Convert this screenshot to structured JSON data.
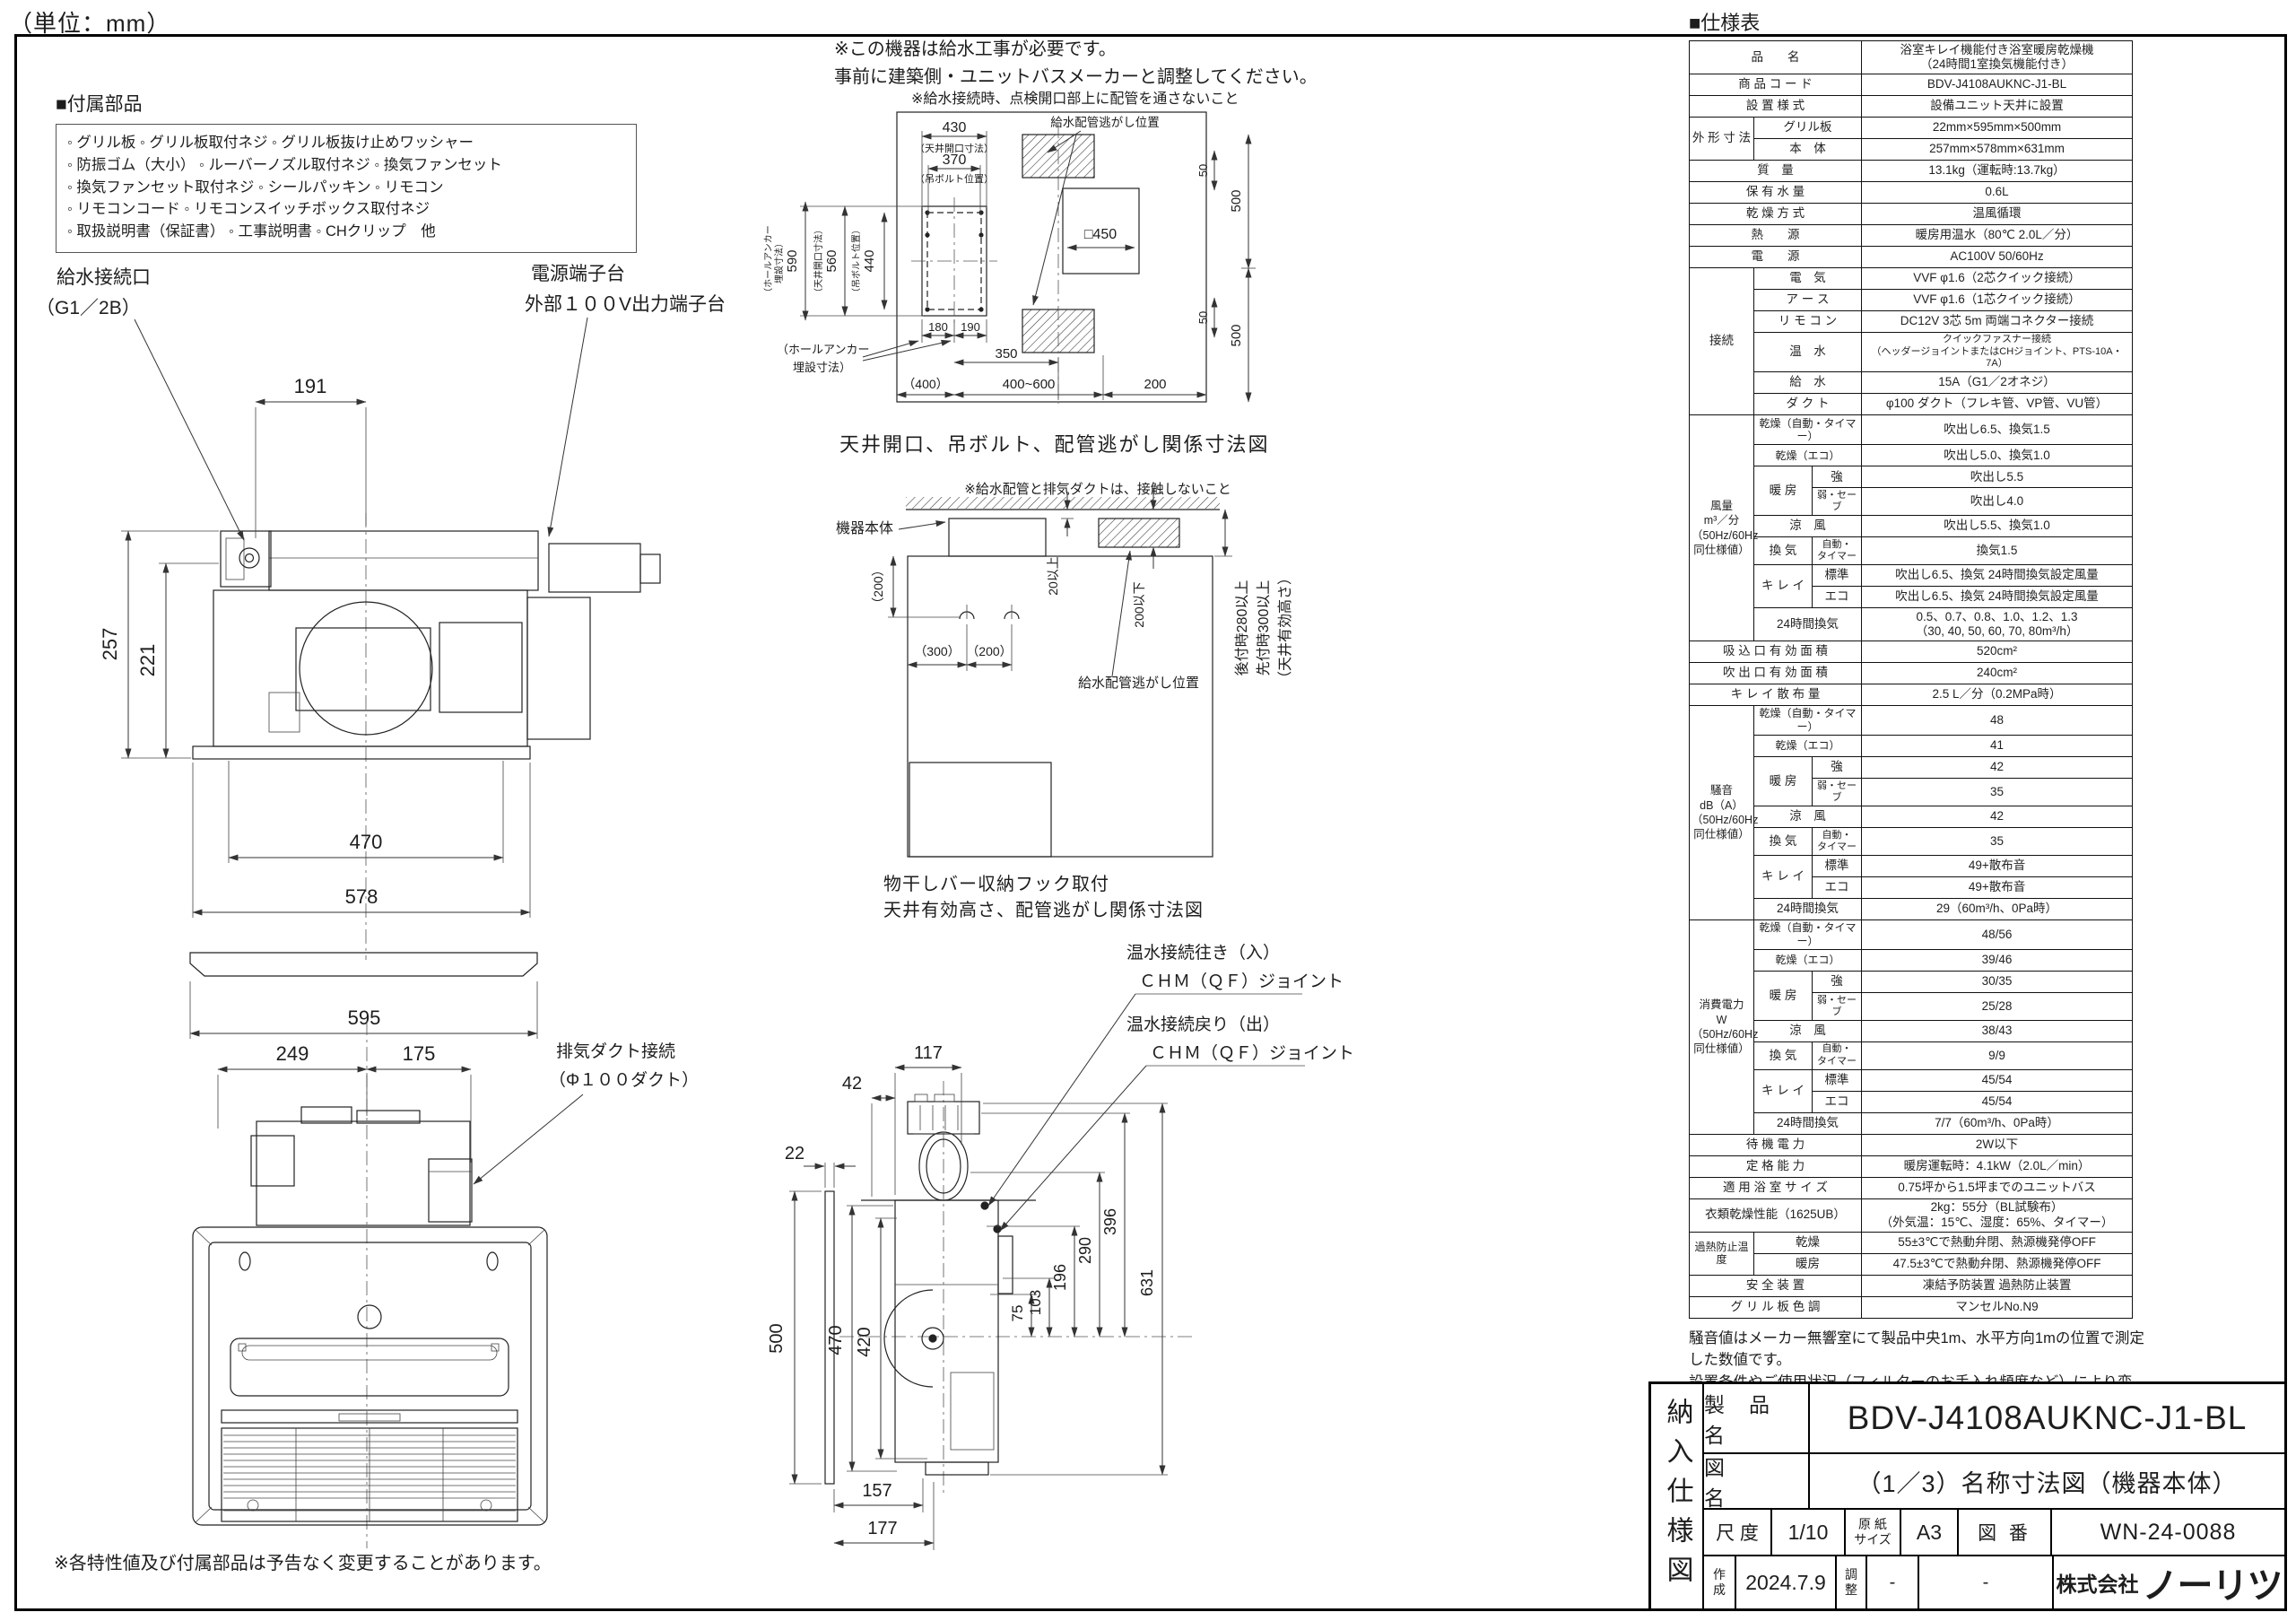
{
  "page": {
    "unit_note": "（単位：mm）",
    "footer_note": "※各特性値及び付属部品は予告なく変更することがあります。"
  },
  "accessories": {
    "heading": "■付属部品",
    "lines": [
      "◦ グリル板 ◦ グリル板取付ネジ ◦ グリル板抜け止めワッシャー",
      "◦ 防振ゴム（大小） ◦ ルーバーノズル取付ネジ ◦ 換気ファンセット",
      "◦ 換気ファンセット取付ネジ ◦ シールパッキン ◦ リモコン",
      "◦ リモコンコード ◦ リモコンスイッチボックス取付ネジ",
      "◦ 取扱説明書（保証書） ◦ 工事説明書 ◦ CHクリップ　他"
    ]
  },
  "top_notes": {
    "line1": "※この機器は給水工事が必要です。",
    "line2": "事前に建築側・ユニットバスメーカーと調整してください。",
    "pipe_note": "※給水接続時、点検開口部上に配管を通さないこと"
  },
  "ceiling_diagram": {
    "caption": "天井開口、吊ボルト、配管逃がし関係寸法図",
    "d430": "430",
    "cap430": "（天井開口寸法）",
    "d370": "370",
    "cap370": "（吊ボルト位置）",
    "d590": "590",
    "cap590a": "（ホールアンカー",
    "cap590b": "埋設寸法）",
    "d560": "560",
    "cap560": "（天井開口寸法）",
    "d440": "440",
    "cap440": "（吊ボルト位置）",
    "anchor_note1": "（ホールアンカー",
    "anchor_note2": "埋設寸法）",
    "d180": "180",
    "d190": "190",
    "d350": "350",
    "d400": "（400）",
    "d400_600": "400~600",
    "d200": "200",
    "pipe_label": "給水配管逃がし位置",
    "d50a": "50",
    "d500a": "500",
    "d450": "□450",
    "d500b": "500",
    "d50b": "50"
  },
  "top_view": {
    "label_water1": "給水接続口",
    "label_water2": "（G1／2B）",
    "label_power1": "電源端子台",
    "label_power2": "外部１００V出力端子台",
    "d191": "191",
    "d257": "257",
    "d221": "221",
    "d470": "470",
    "d578": "578",
    "d595": "595"
  },
  "install_diagram": {
    "note": "※給水配管と排気ダクトは、接触しないこと",
    "body_label": "機器本体",
    "d200p": "（200）",
    "d300p": "（300）",
    "d200p2": "（200）",
    "d20": "20以上",
    "d200max": "200以下",
    "pipe_label": "給水配管逃がし位置",
    "v1": "後付時280以上",
    "v2": "先付時300以上",
    "v3": "（天井有効高さ）",
    "caption1": "物干しバー収納フック取付",
    "caption2": "天井有効高さ、配管逃がし関係寸法図"
  },
  "front_view": {
    "d249": "249",
    "d175": "175",
    "duct_label1": "排気ダクト接続",
    "duct_label2": "（Φ１００ダクト）"
  },
  "side_view": {
    "d117": "117",
    "d42": "42",
    "d22": "22",
    "d500": "500",
    "d470": "470",
    "d420": "420",
    "d75": "75",
    "d103": "103",
    "d196": "196",
    "d290": "290",
    "d396": "396",
    "d631": "631",
    "d157": "157",
    "d177": "177",
    "hot_in1": "温水接続往き（入）",
    "hot_in2": "ＣＨＭ（ＱＦ）ジョイント",
    "hot_out1": "温水接続戻り（出）",
    "hot_out2": "ＣＨＭ（ＱＦ）ジョイント"
  },
  "spec": {
    "heading": "■仕様表",
    "note1": "騒音値はメーカー無響室にて製品中央1m、水平方向1mの位置で測定した数値です。",
    "note2": "設置条件やご使用状況（フィルターのお手入れ頻度など）により変わります。",
    "rows": [
      [
        "品　　名",
        "浴室キレイ機能付き浴室暖房乾燥機\n（24時間1室換気機能付き）"
      ],
      [
        "商 品 コ ー ド",
        "BDV-J4108AUKNC-J1-BL"
      ],
      [
        "設 置 様 式",
        "設備ユニット天井に設置"
      ],
      [
        "外 形 寸 法",
        "グリル板",
        "22mm×595mm×500mm"
      ],
      [
        "本　体",
        "257mm×578mm×631mm"
      ],
      [
        "質　量",
        "13.1kg（運転時:13.7kg）"
      ],
      [
        "保 有 水 量",
        "0.6L"
      ],
      [
        "乾 燥 方 式",
        "温風循環"
      ],
      [
        "熱　　源",
        "暖房用温水（80℃ 2.0L／分）"
      ],
      [
        "電　　源",
        "AC100V 50/60Hz"
      ],
      [
        "接続",
        "電　気",
        "VVF φ1.6（2芯クイック接続）"
      ],
      [
        "ア ー ス",
        "VVF φ1.6（1芯クイック接続）"
      ],
      [
        "リ モ コ ン",
        "DC12V 3芯 5m 両端コネクター接続"
      ],
      [
        "温　水",
        "クイックファスナー接続\n（ヘッダージョイントまたはCHジョイント、PTS-10A・7A）"
      ],
      [
        "給　水",
        "15A（G1／2オネジ）"
      ],
      [
        "ダ ク ト",
        "φ100 ダクト（フレキ管、VP管、VU管）"
      ],
      [
        "風量\nm³／分\n（50Hz/60Hz\n同仕様値）",
        "乾燥（自動・タイマー）",
        "吹出し6.5、換気1.5"
      ],
      [
        "乾燥（エコ）",
        "吹出し5.0、換気1.0"
      ],
      [
        "暖 房",
        "強",
        "吹出し5.5"
      ],
      [
        "弱・セーブ",
        "吹出し4.0"
      ],
      [
        "涼　風",
        "吹出し5.5、換気1.0"
      ],
      [
        "換 気",
        "自動・\nタイマー",
        "換気1.5"
      ],
      [
        "キ レ イ",
        "標準",
        "吹出し6.5、換気 24時間換気設定風量"
      ],
      [
        "エコ",
        "吹出し6.5、換気 24時間換気設定風量"
      ],
      [
        "24時間換気",
        "0.5、0.7、0.8、1.0、1.2、1.3\n（30, 40, 50, 60, 70, 80m³/h）"
      ],
      [
        "吸 込 口 有 効 面 積",
        "520cm²"
      ],
      [
        "吹 出 口 有 効 面 積",
        "240cm²"
      ],
      [
        "キ レ イ 散 布 量",
        "2.5 L／分（0.2MPa時）"
      ],
      [
        "騒音\ndB（A）\n（50Hz/60Hz\n同仕様値）",
        "乾燥（自動・タイマー）",
        "48"
      ],
      [
        "乾燥（エコ）",
        "41"
      ],
      [
        "暖 房",
        "強",
        "42"
      ],
      [
        "弱・セーブ",
        "35"
      ],
      [
        "涼　風",
        "42"
      ],
      [
        "換 気",
        "自動・\nタイマー",
        "35"
      ],
      [
        "キ レ イ",
        "標準",
        "49+散布音"
      ],
      [
        "エコ",
        "49+散布音"
      ],
      [
        "24時間換気",
        "29（60m³/h、0Pa時）"
      ],
      [
        "消費電力\nW\n（50Hz/60Hz\n同仕様値）",
        "乾燥（自動・タイマー）",
        "48/56"
      ],
      [
        "乾燥（エコ）",
        "39/46"
      ],
      [
        "暖 房",
        "強",
        "30/35"
      ],
      [
        "弱・セーブ",
        "25/28"
      ],
      [
        "涼　風",
        "38/43"
      ],
      [
        "換 気",
        "自動・\nタイマー",
        "9/9"
      ],
      [
        "キ レ イ",
        "標準",
        "45/54"
      ],
      [
        "エコ",
        "45/54"
      ],
      [
        "24時間換気",
        "7/7（60m³/h、0Pa時）"
      ],
      [
        "待 機 電 力",
        "2W以下"
      ],
      [
        "定 格 能 力",
        "暖房運転時：4.1kW（2.0L／min）"
      ],
      [
        "適 用 浴 室 サ イ ズ",
        "0.75坪から1.5坪までのユニットバス"
      ],
      [
        "衣類乾燥性能（1625UB）",
        "2kg：55分（BL試験布）\n（外気温：15℃、湿度：65%、タイマー）"
      ],
      [
        "過熱防止温度",
        "乾燥",
        "55±3℃で熱動弁閉、熱源機発停OFF"
      ],
      [
        "暖房",
        "47.5±3℃で熱動弁閉、熱源機発停OFF"
      ],
      [
        "安 全 装 置",
        "凍結予防装置 過熱防止装置"
      ],
      [
        "グ リ ル 板 色 調",
        "マンセルNo.N9"
      ]
    ]
  },
  "title_block": {
    "doc_type": "納入仕様図",
    "product_label": "製　品　名",
    "product_value": "BDV-J4108AUKNC-J1-BL",
    "drawing_label": "図　　　名",
    "drawing_value": "（1／3）名称寸法図（機器本体）",
    "scale_label": "尺 度",
    "scale_value": "1/10",
    "paper_label": "原 紙\nサイズ",
    "paper_value": "A3",
    "no_label": "図 番",
    "no_value": "WN-24-0088",
    "created_label": "作\n成",
    "created_value": "2024.7.9",
    "adjust_label": "調\n整",
    "adjust_value": "-",
    "dash": "-",
    "company_prefix": "株式会社",
    "company_name": "ノーリツ"
  }
}
